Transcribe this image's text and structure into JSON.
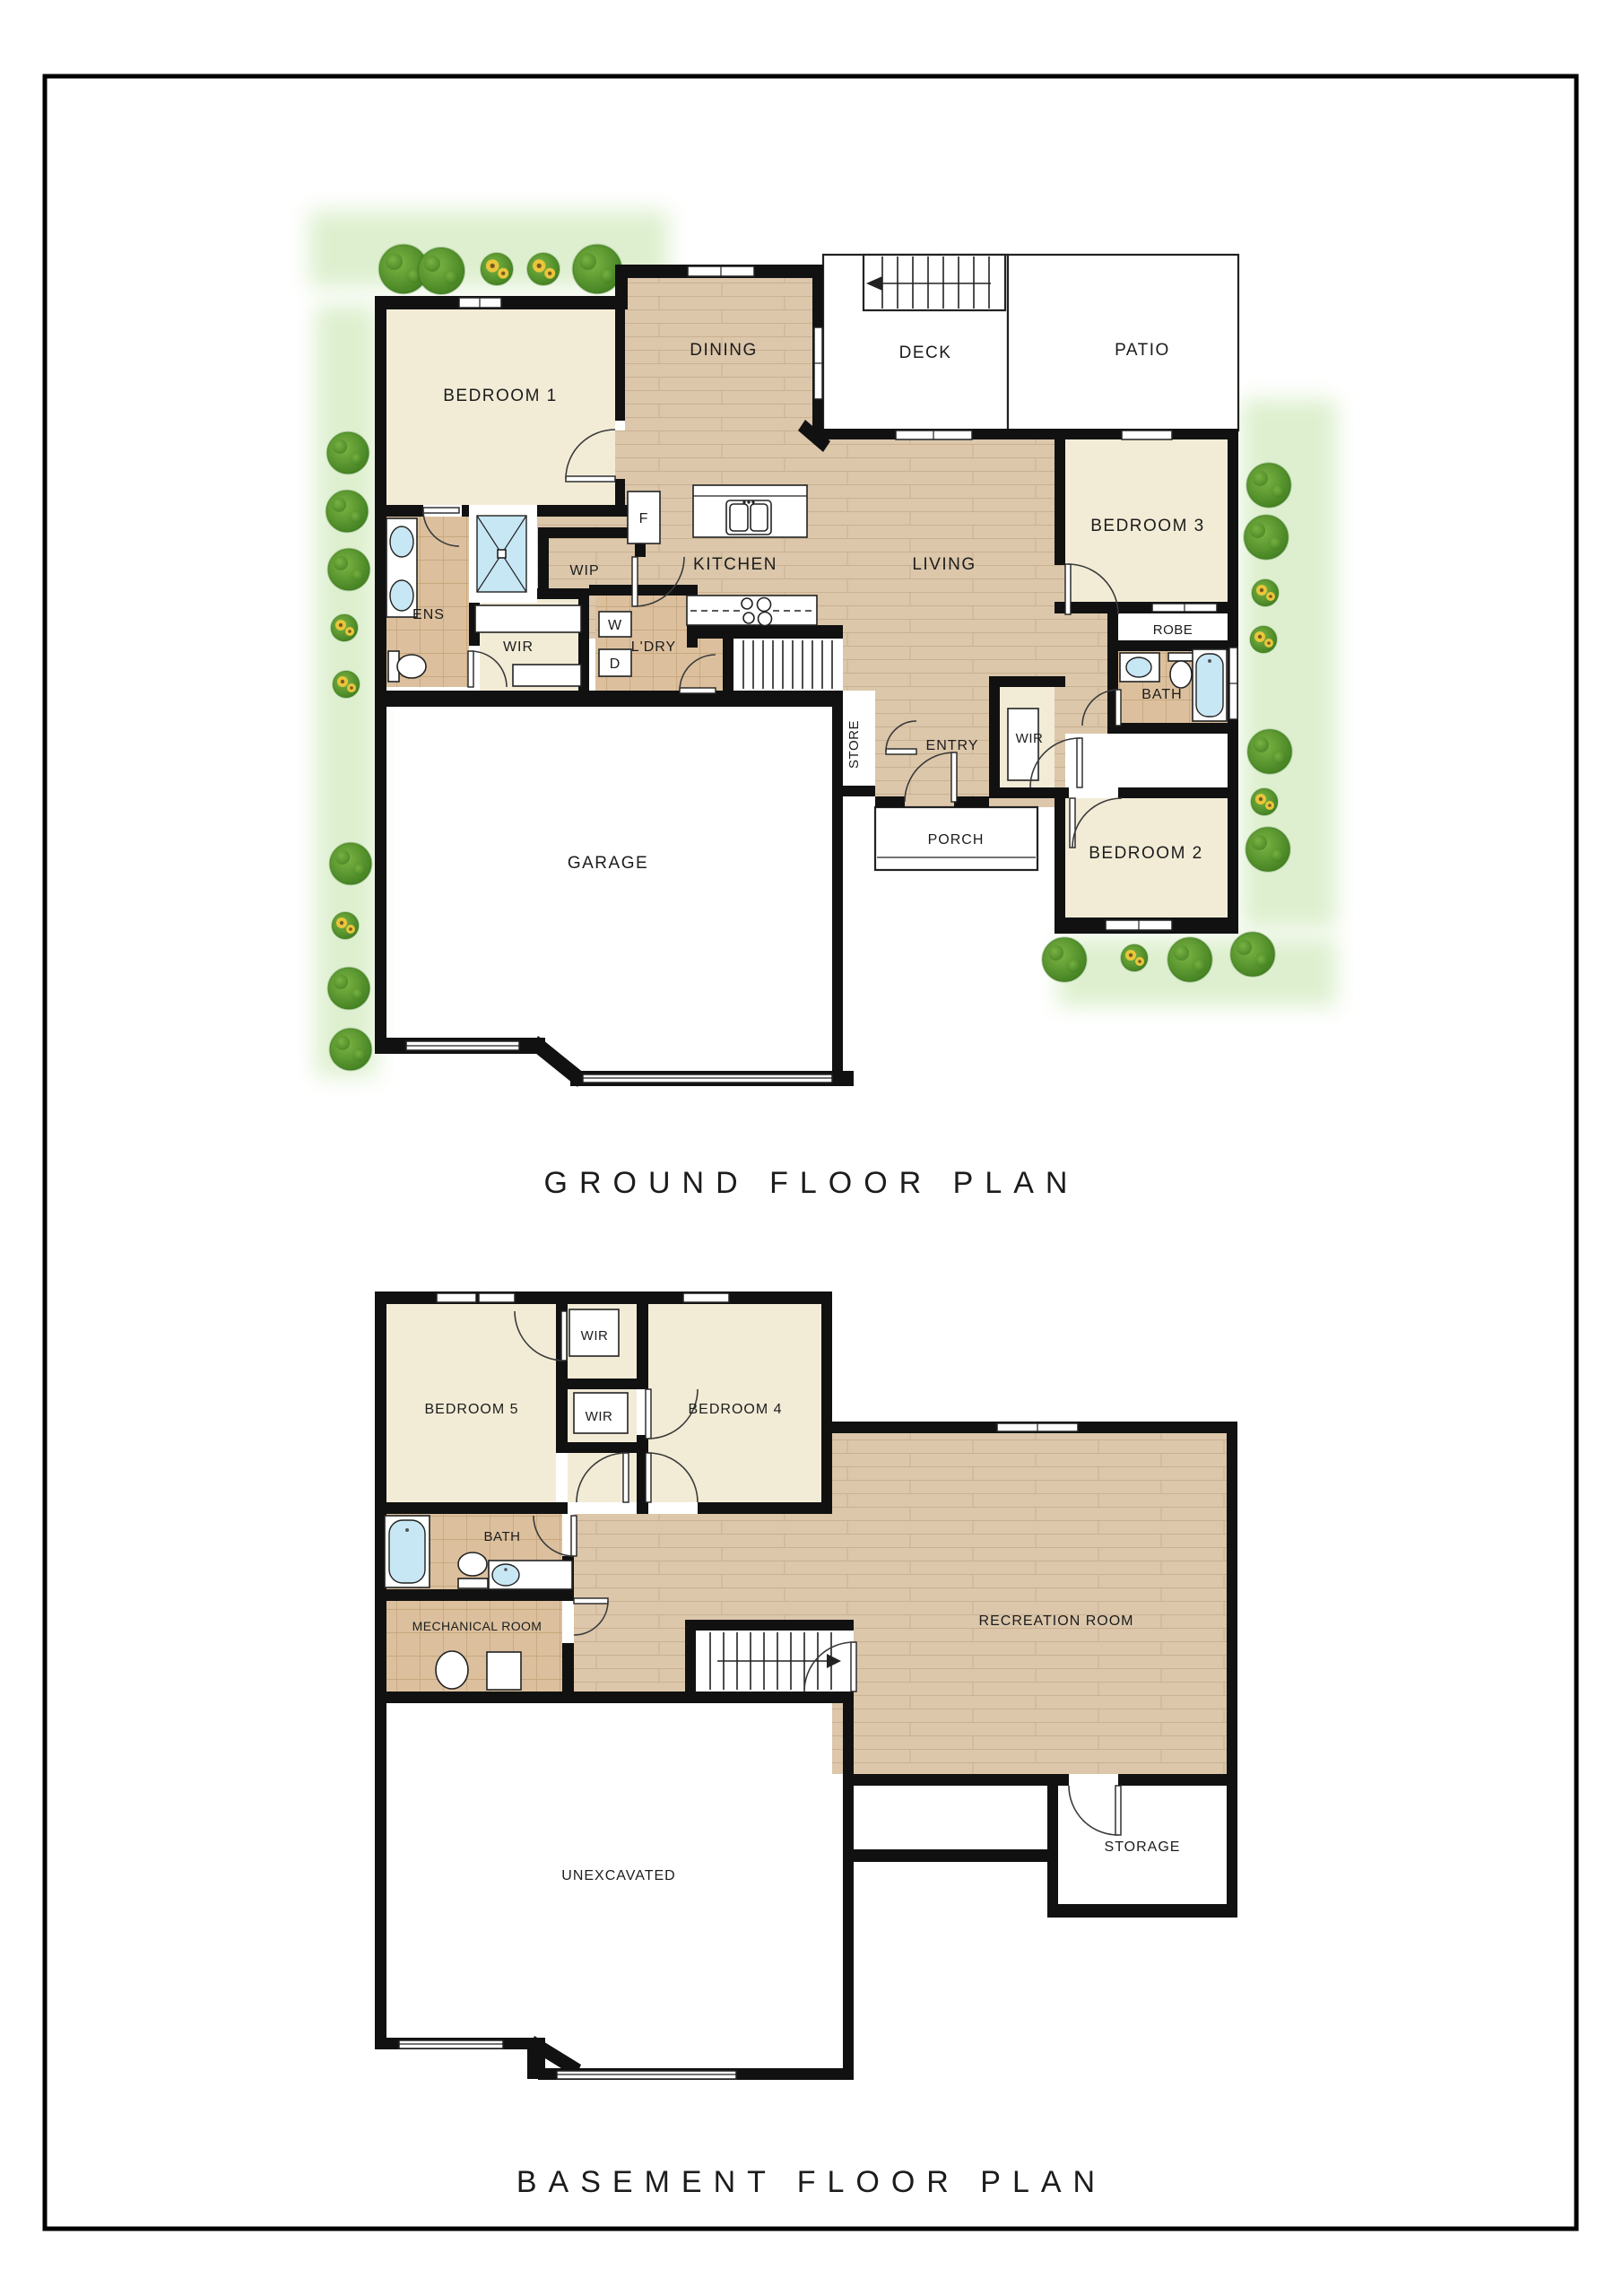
{
  "titles": {
    "ground": "GROUND FLOOR PLAN",
    "basement": "BASEMENT FLOOR PLAN"
  },
  "ground": {
    "rooms": {
      "bedroom1": "BEDROOM 1",
      "dining": "DINING",
      "deck": "DECK",
      "patio": "PATIO",
      "bedroom3": "BEDROOM 3",
      "kitchen": "KITCHEN",
      "living": "LIVING",
      "ens": "ENS",
      "wir": "WIR",
      "wip": "WIP",
      "ldry": "L'DRY",
      "fridge": "F",
      "washer": "W",
      "dryer": "D",
      "store": "STORE",
      "entry": "ENTRY",
      "entry_wir": "WIR",
      "robe": "ROBE",
      "bath": "BATH",
      "bedroom2": "BEDROOM 2",
      "porch": "PORCH",
      "garage": "GARAGE"
    }
  },
  "basement": {
    "rooms": {
      "bedroom5": "BEDROOM 5",
      "wir_top": "WIR",
      "wir_mid": "WIR",
      "bedroom4": "BEDROOM 4",
      "bath": "BATH",
      "mechanical": "MECHANICAL ROOM",
      "recreation": "RECREATION ROOM",
      "unexcavated": "UNEXCAVATED",
      "storage": "STORAGE"
    }
  },
  "colors": {
    "wall": "#111111",
    "bedroom_fill": "#f2ecd7",
    "wood_fill": "#dcc7ab",
    "wood_line": "#c9b191",
    "tile_fill": "#dcc09e",
    "tile_line": "#c7a87e",
    "water_fill": "#c8e7f4",
    "greenery_fill": "#dcefcc",
    "bush_light": "#7cb544",
    "bush_dark": "#3f7d1f",
    "sunflower_yellow": "#e9c63b"
  }
}
